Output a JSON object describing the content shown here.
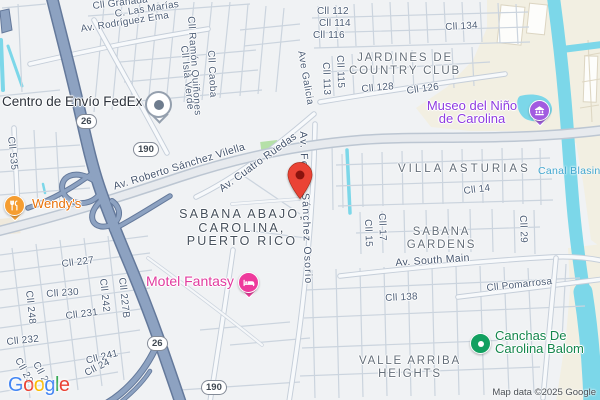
{
  "map": {
    "streets": [
      {
        "name": "Cll Granada"
      },
      {
        "name": "C. Las Marías"
      },
      {
        "name": "Av. Rodríguez Ema"
      },
      {
        "name": "Cll Ramón Quiñones"
      },
      {
        "name": "Cll Caoba"
      },
      {
        "name": "Cll Isla Verde"
      },
      {
        "name": "Cll 112"
      },
      {
        "name": "Cll 114"
      },
      {
        "name": "Cll 116"
      },
      {
        "name": "Cll 134"
      },
      {
        "name": "Ave Galicia"
      },
      {
        "name": "Cll 113"
      },
      {
        "name": "Cll 115"
      },
      {
        "name": "Cll 128"
      },
      {
        "name": "Cll 126"
      },
      {
        "name": "Cll 535"
      },
      {
        "name": "Av. Roberto Sánchez Vilella"
      },
      {
        "name": "Av. Cuatro Ruedas"
      },
      {
        "name": "Av. Felipe Sánchez Osorio"
      },
      {
        "name": "Cll 14"
      },
      {
        "name": "Cll 15"
      },
      {
        "name": "Cll 17"
      },
      {
        "name": "Cll 29"
      },
      {
        "name": "Av. South Main"
      },
      {
        "name": "Cll Pomarrosa"
      },
      {
        "name": "Cll 138"
      },
      {
        "name": "Cll 227"
      },
      {
        "name": "Cll 230"
      },
      {
        "name": "Cll 248"
      },
      {
        "name": "Cll 242"
      },
      {
        "name": "Cll 227B"
      },
      {
        "name": "Cll 231"
      },
      {
        "name": "Cll 232"
      },
      {
        "name": "Cll 241"
      },
      {
        "name": "Cll 24"
      },
      {
        "name": "Cll 23"
      },
      {
        "name": "Cll 2"
      }
    ],
    "route_badges": [
      "26",
      "190",
      "26",
      "190"
    ],
    "areas": {
      "jardines": {
        "line1": "JARDINES DE",
        "line2": "COUNTRY CLUB"
      },
      "villa_asturias": "VILLA ASTURIAS",
      "sabana_gardens": {
        "line1": "SABANA",
        "line2": "GARDENS"
      },
      "sabana_abajo": {
        "line1": "SABANA ABAJO,",
        "line2": "CAROLINA,",
        "line3": "PUERTO RICO"
      },
      "valle_arriba": {
        "line1": "VALLE ARRIBA",
        "line2": "HEIGHTS"
      }
    },
    "water_labels": {
      "canal": "Canal Blasina"
    },
    "pois": {
      "fedex": {
        "label": "Centro de Envío FedEx"
      },
      "wendys": {
        "label": "Wendy's"
      },
      "motel": {
        "label": "Motel Fantasy"
      },
      "museo": {
        "line1": "Museo del Niño",
        "line2": "de Carolina"
      },
      "canchas": {
        "line1": "Canchas De",
        "line2": "Carolina Balom"
      }
    },
    "colors": {
      "pin_red": "#EA4335",
      "expressway_blue": "#8da2c1",
      "water_cyan": "#7cd7e9",
      "poi_orange": "#f59d31",
      "poi_pink": "#ee3a9c",
      "poi_purple": "#a25be0",
      "poi_green": "#12a060",
      "restaurant_text_orange": "#e8710a",
      "lodging_text_pink": "#e13b9e",
      "museum_text_purple": "#8e3be0",
      "park_text_green": "#15864d",
      "water_text_blue": "#42a7d0"
    }
  },
  "attribution": {
    "logo_letters": [
      "G",
      "o",
      "o",
      "g",
      "l",
      "e"
    ],
    "map_data": "Map data ©2025 Google"
  }
}
